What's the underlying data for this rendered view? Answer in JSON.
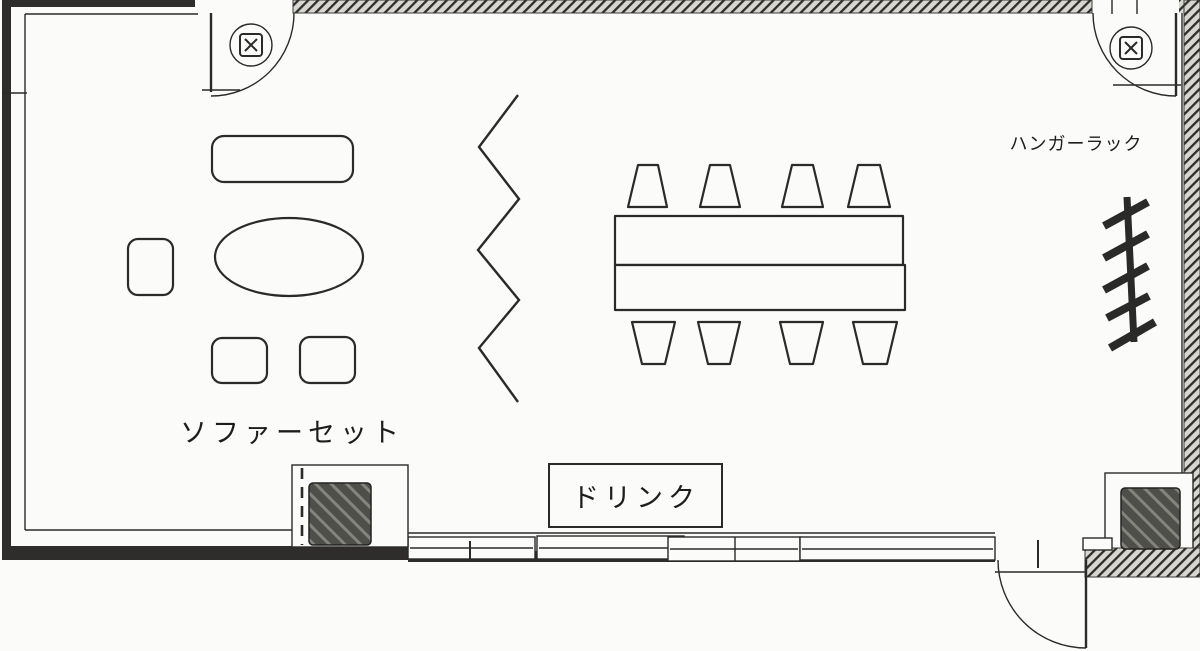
{
  "labels": {
    "sofa_set": "ソファーセット",
    "drink": "ドリンク",
    "hanger_rack": "ハンガーラック"
  },
  "icons": {
    "door_sign_symbol": "circle enclosing rounded square with X",
    "hanger_rack_symbol": "rail bar with five diagonal hooks",
    "partition_symbol": "vertical zigzag line"
  },
  "colors": {
    "background": "#fbfbf9",
    "line": "#2a2a28",
    "wall": "#2e2d2b",
    "pillar": "#4e4e4a",
    "pillar_stripe": "#84847c",
    "hatchbg": "#d8d6d0"
  }
}
